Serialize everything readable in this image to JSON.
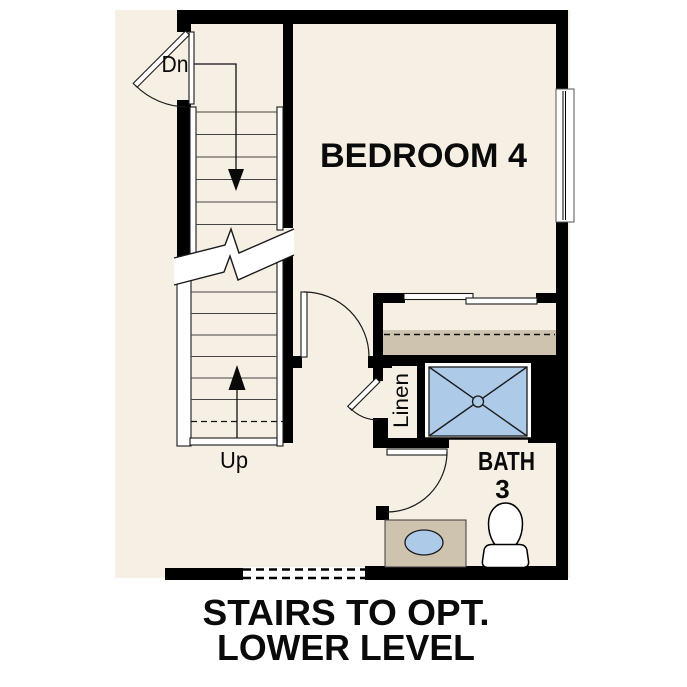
{
  "floorplan": {
    "rooms": {
      "bedroom": {
        "label": "BEDROOM 4"
      },
      "bath": {
        "label": "BATH",
        "number": "3"
      },
      "linen": {
        "label": "Linen"
      }
    },
    "stairs": {
      "down_label": "Dn",
      "up_label": "Up"
    },
    "caption": {
      "line1": "STAIRS TO OPT.",
      "line2": "LOWER LEVEL"
    },
    "colors": {
      "page_background": "#FFFFFF",
      "floor": "#F6EFE3",
      "wall": "#000000",
      "shelf_tan": "#CDC3AE",
      "fixture_blue": "#ADCAE8",
      "line": "#444444"
    }
  }
}
